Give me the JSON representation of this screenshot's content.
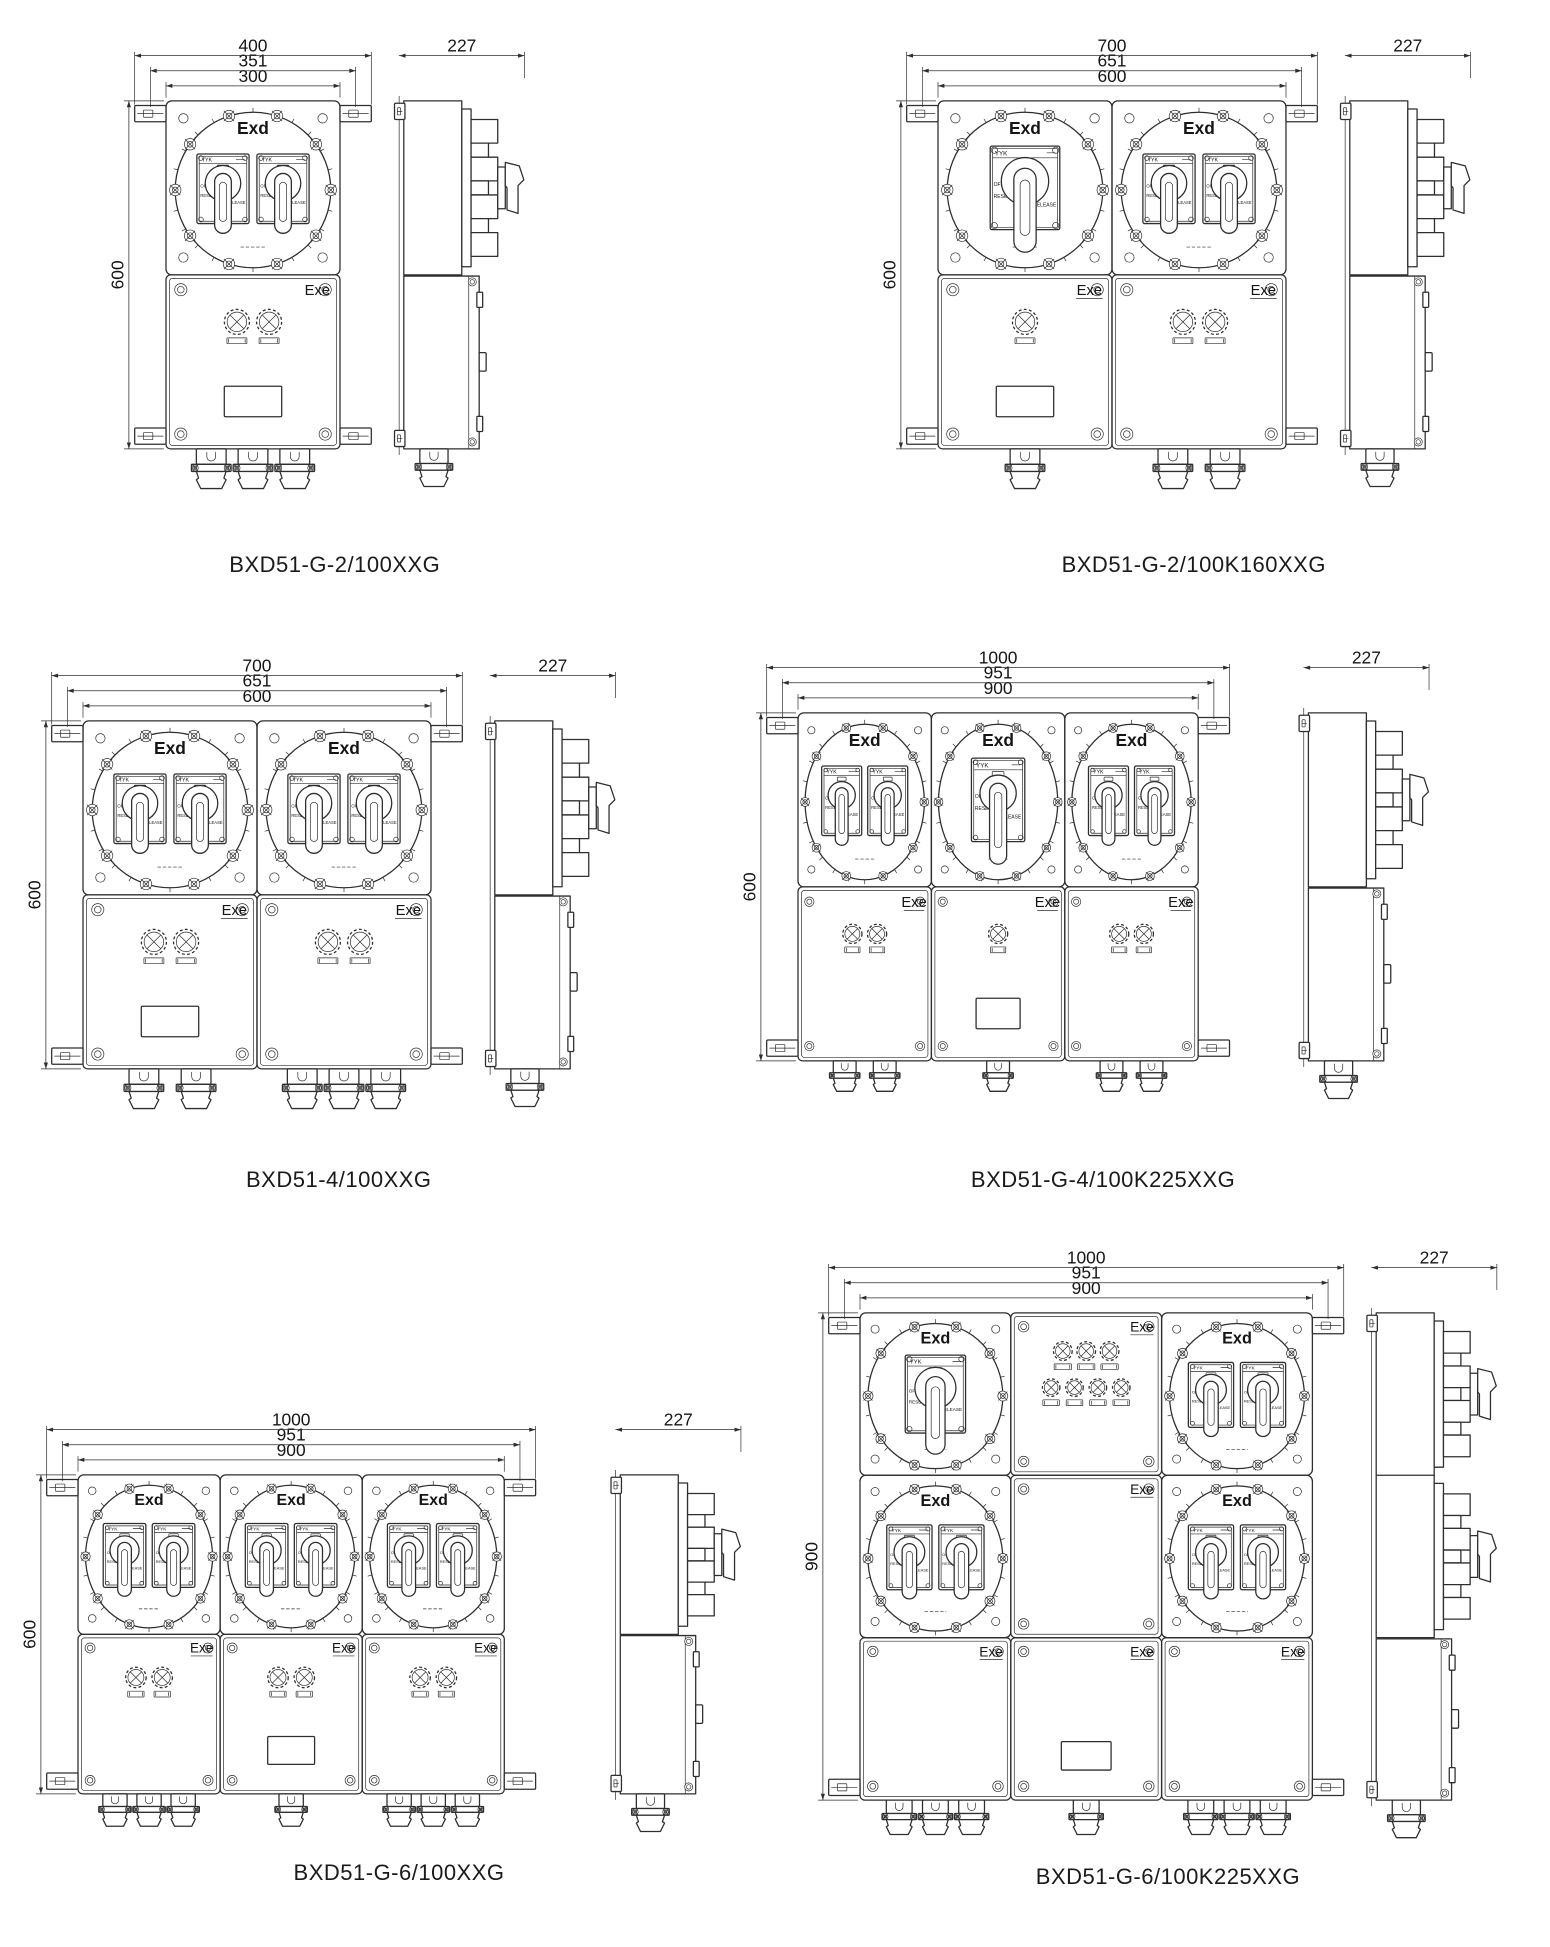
{
  "page": {
    "background": "#ffffff",
    "line_color": "#2e2e2e",
    "text_color": "#151515"
  },
  "labels": {
    "exd": "Exd",
    "exe": "Exe",
    "switch_brand": "YYK",
    "switch_off": "OFF",
    "switch_reset": "RESET",
    "switch_release": "RELEASE"
  },
  "figures": [
    {
      "caption": "BXD51-G-2/100XXG",
      "dims": {
        "outer": "400",
        "mid": "351",
        "inner": "300",
        "height": "600",
        "depth": "227"
      },
      "front": {
        "rows": [
          [
            {
              "kind": "exd",
              "switch": "double"
            }
          ],
          [
            {
              "kind": "exe",
              "lamps": 2,
              "nameplate": true,
              "underline": false
            }
          ]
        ],
        "glands": [
          3
        ]
      },
      "side": {
        "exd_rows": 1
      }
    },
    {
      "caption": "BXD51-G-2/100K160XXG",
      "dims": {
        "outer": "700",
        "mid": "651",
        "inner": "600",
        "height": "600",
        "depth": "227"
      },
      "front": {
        "rows": [
          [
            {
              "kind": "exd",
              "switch": "single"
            },
            {
              "kind": "exd",
              "switch": "double"
            }
          ],
          [
            {
              "kind": "exe",
              "lamps": 1,
              "nameplate": true
            },
            {
              "kind": "exe",
              "lamps": 2
            }
          ]
        ],
        "glands": [
          1,
          2
        ]
      },
      "side": {
        "exd_rows": 1
      }
    },
    {
      "caption": "BXD51-4/100XXG",
      "dims": {
        "outer": "700",
        "mid": "651",
        "inner": "600",
        "height": "600",
        "depth": "227"
      },
      "front": {
        "rows": [
          [
            {
              "kind": "exd",
              "switch": "double"
            },
            {
              "kind": "exd",
              "switch": "double"
            }
          ],
          [
            {
              "kind": "exe",
              "lamps": 2,
              "nameplate": true
            },
            {
              "kind": "exe",
              "lamps": 2
            }
          ]
        ],
        "glands": [
          2,
          3
        ]
      },
      "side": {
        "exd_rows": 1
      }
    },
    {
      "caption": "BXD51-G-4/100K225XXG",
      "dims": {
        "outer": "1000",
        "mid": "951",
        "inner": "900",
        "height": "600",
        "depth": "227"
      },
      "front": {
        "rows": [
          [
            {
              "kind": "exd",
              "switch": "double"
            },
            {
              "kind": "exd",
              "switch": "single"
            },
            {
              "kind": "exd",
              "switch": "double"
            }
          ],
          [
            {
              "kind": "exe",
              "lamps": 2
            },
            {
              "kind": "exe",
              "lamps": 1,
              "nameplate": true
            },
            {
              "kind": "exe",
              "lamps": 2
            }
          ]
        ],
        "glands": [
          2,
          1,
          2
        ]
      },
      "side": {
        "exd_rows": 1
      }
    },
    {
      "caption": "BXD51-G-6/100XXG",
      "dims": {
        "outer": "1000",
        "mid": "951",
        "inner": "900",
        "height": "600",
        "depth": "227"
      },
      "front": {
        "rows": [
          [
            {
              "kind": "exd",
              "switch": "double"
            },
            {
              "kind": "exd",
              "switch": "double"
            },
            {
              "kind": "exd",
              "switch": "double"
            }
          ],
          [
            {
              "kind": "exe",
              "lamps": 2
            },
            {
              "kind": "exe",
              "lamps": 2,
              "nameplate": true
            },
            {
              "kind": "exe",
              "lamps": 2
            }
          ]
        ],
        "glands": [
          3,
          1,
          3
        ]
      },
      "side": {
        "exd_rows": 1
      }
    },
    {
      "caption": "BXD51-G-6/100K225XXG",
      "dims": {
        "outer": "1000",
        "mid": "951",
        "inner": "900",
        "height": "900",
        "depth": "227"
      },
      "front": {
        "rows": [
          [
            {
              "kind": "exd",
              "switch": "single"
            },
            {
              "kind": "exe",
              "lamp_rows": [
                3,
                4
              ]
            },
            {
              "kind": "exd",
              "switch": "double"
            }
          ],
          [
            {
              "kind": "exd",
              "switch": "double"
            },
            {
              "kind": "exe"
            },
            {
              "kind": "exd",
              "switch": "double"
            }
          ],
          [
            {
              "kind": "exe"
            },
            {
              "kind": "exe",
              "nameplate": true
            },
            {
              "kind": "exe"
            }
          ]
        ],
        "glands": [
          3,
          1,
          3
        ]
      },
      "side": {
        "exd_rows": 2
      }
    }
  ]
}
